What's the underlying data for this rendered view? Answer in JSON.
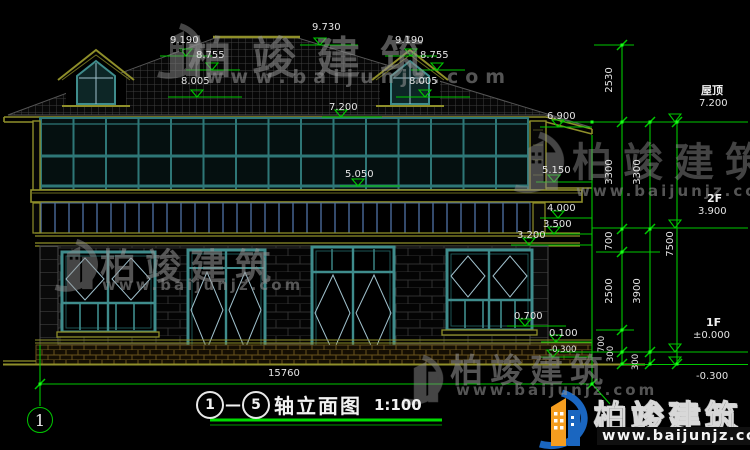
{
  "drawing": {
    "title": {
      "axis_start": "1",
      "dash": "—",
      "axis_end": "5",
      "name": "轴立面图",
      "scale": "1:100"
    },
    "axis_bubbles": {
      "left": "1"
    },
    "elevation_marks": [
      "9.730",
      "9.190",
      "8.755",
      "8.005",
      "9.190",
      "8.755",
      "8.005",
      "7.200",
      "6.900",
      "5.050",
      "5.150",
      "4.000",
      "3.500",
      "3.200",
      "0.700",
      "0.100",
      "-0.300"
    ],
    "level_labels": {
      "roof_name": "屋顶",
      "roof_elev": "7.200",
      "f2_name": "2F",
      "f2_elev": "3.900",
      "f1_name": "1F",
      "f1_elev": "±0.000",
      "ground_elev": "-0.300"
    },
    "dimensions": {
      "right_chain_inner": [
        "2530",
        "3300",
        "700",
        "2500",
        "700",
        "300"
      ],
      "right_chain_mid": [
        "3300",
        "3900",
        "300"
      ],
      "right_chain_outer": [
        "7500"
      ],
      "bottom": [
        "15760"
      ]
    },
    "colors": {
      "dim_green": "#00c800",
      "outline_olive": "#8f8f2a",
      "frame_teal": "#3f8c8c"
    }
  },
  "watermark": {
    "brand": "柏竣建筑",
    "url": "www.baijunjz.com"
  },
  "logo": {
    "brand": "柏竣建筑",
    "url": "www.baijunjz.com"
  }
}
